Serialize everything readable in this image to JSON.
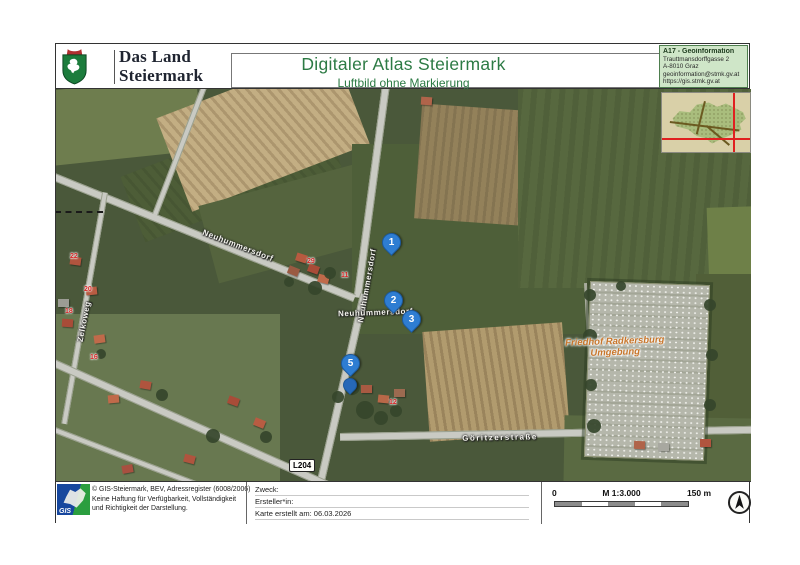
{
  "header": {
    "logo_line1": "Das Land",
    "logo_line2": "Steiermark",
    "title": "Digitaler Atlas Steiermark",
    "subtitle": "Luftbild ohne Markierung",
    "info": {
      "dept": "A17 - Geoinformation",
      "street": "Trauttmansdorffgasse 2",
      "city": "A-8010 Graz",
      "email": "geoinformation@stmk.gv.at",
      "url": "https://gis.stmk.gv.at"
    }
  },
  "map": {
    "markers": [
      {
        "label": "1"
      },
      {
        "label": "2"
      },
      {
        "label": "3"
      },
      {
        "label": "5"
      },
      {
        "label": ""
      }
    ],
    "streets": {
      "neuhummersdorf_road": "Neuhummersdorf",
      "neuhummersdorf_diag": "Neuhummersdorf",
      "neuhummersdorf_junction": "Neuhummersdorf",
      "zelkoweg": "Zelkoweg",
      "goritzerstrasse": "Göritzerstraße",
      "route_badge": "L204"
    },
    "cemetery_label_line1": "Friedhof Radkersburg",
    "cemetery_label_line2": "Umgebung",
    "house_numbers": [
      {
        "value": "22"
      },
      {
        "value": "20"
      },
      {
        "value": "18"
      },
      {
        "value": "29"
      },
      {
        "value": "11"
      },
      {
        "value": "16"
      },
      {
        "value": "12"
      }
    ]
  },
  "footer": {
    "logo_text": "GIS",
    "copyright": {
      "line1": "© GIS-Steiermark, BEV, Adressregister (6008/2006)",
      "line2": "Keine Haftung für Verfügbarkeit, Vollständigkeit",
      "line3": "und Richtigkeit der Darstellung."
    },
    "meta": {
      "purpose": "Zweck:",
      "creator": "Ersteller*in:",
      "created": "Karte erstellt am: 06.03.2026"
    },
    "scale": {
      "start": "0",
      "ratio": "M 1:3.000",
      "end": "150 m"
    }
  },
  "colors": {
    "title_green": "#2c7a44",
    "info_box_bg": "#cfe6c8",
    "marker_blue": "#2e7dd2",
    "house_number_red": "#d42525",
    "cemetery_label_orange": "#c8762b"
  }
}
